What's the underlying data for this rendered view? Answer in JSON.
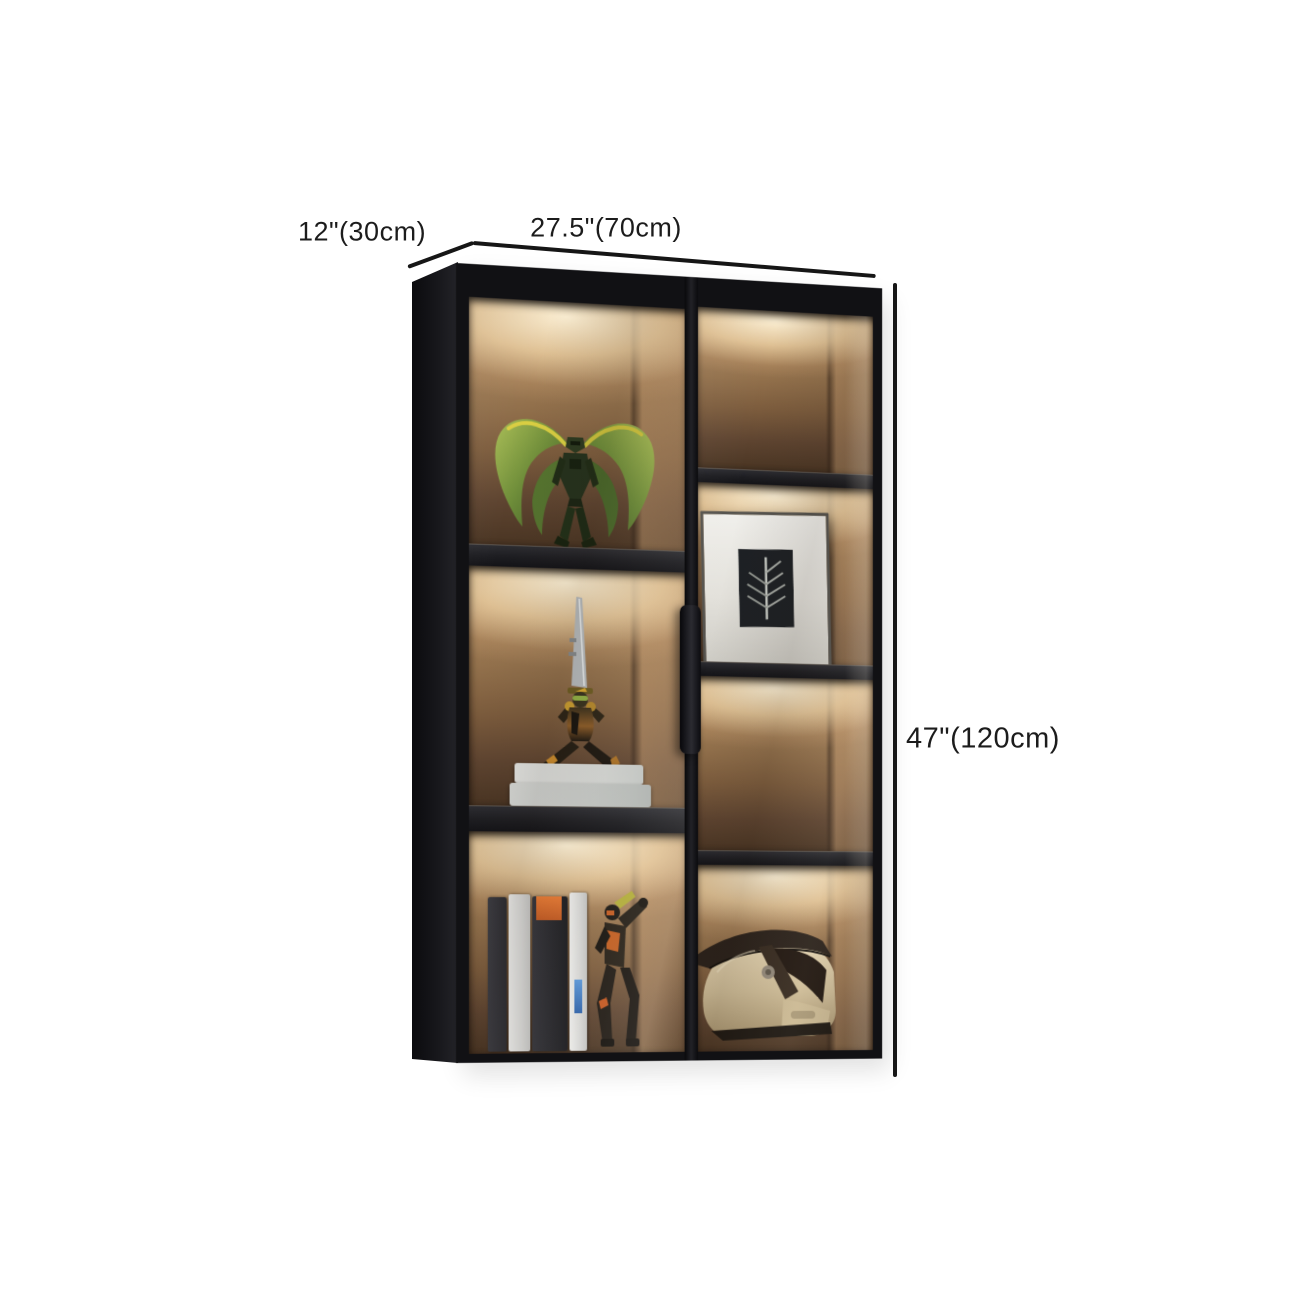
{
  "annotations": {
    "depth_label": "12\"(30cm)",
    "width_label": "27.5\"(70cm)",
    "height_label": "47\"(120cm)"
  },
  "scene": {
    "subject": "black wall-mounted display cabinet with glass doors and warm LED-lit compartments",
    "objects": [
      "green mecha figurine",
      "sword figurine standing on two light books",
      "row of books with orange-label spine and dark action figure",
      "framed leaf artwork print",
      "cream motocross helmet"
    ]
  },
  "colors": {
    "background": "#ffffff",
    "cabinet_frame": "#141417",
    "interior_glow": "#f4e3c2",
    "interior_wood": "#a27c58",
    "shelf": "#232327",
    "dimension_line": "#161616",
    "label_text": "#1c1c1c",
    "accent_orange": "#c25a22",
    "figure_green": "#6d8c39",
    "helmet_shell": "#d9c8a5"
  }
}
